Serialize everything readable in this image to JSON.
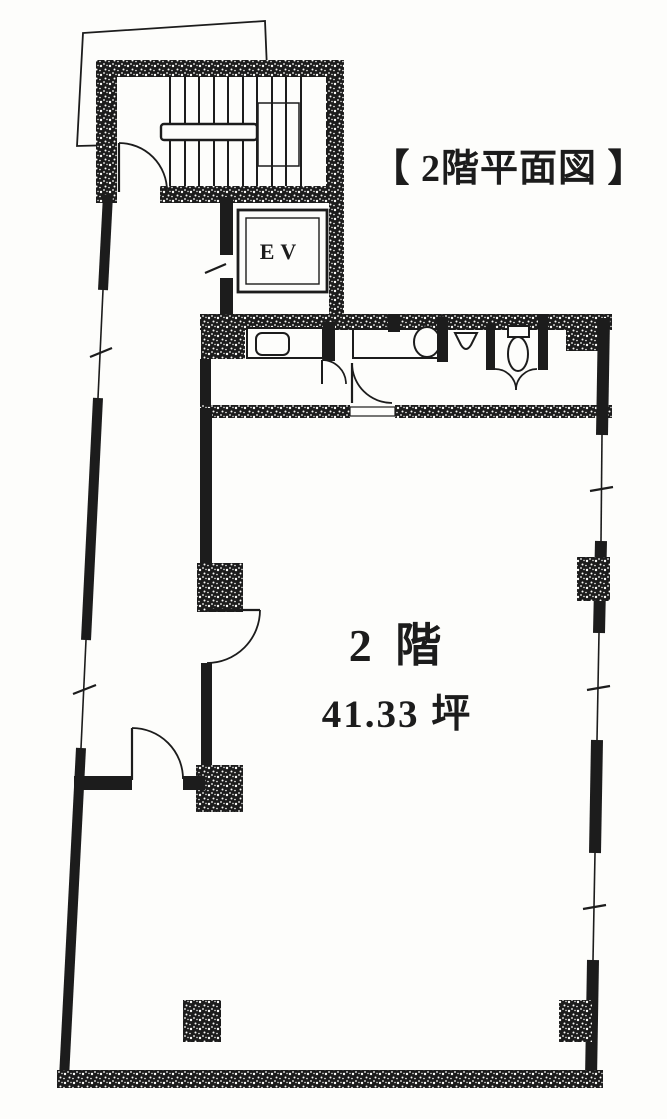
{
  "colors": {
    "paper": "#fdfdfb",
    "ink": "#1c1c1c"
  },
  "title": {
    "text": "【 2階平面図 】"
  },
  "plan": {
    "floor_label": "2 階",
    "area_label": "41.33 坪",
    "elevator_label": "EV"
  }
}
